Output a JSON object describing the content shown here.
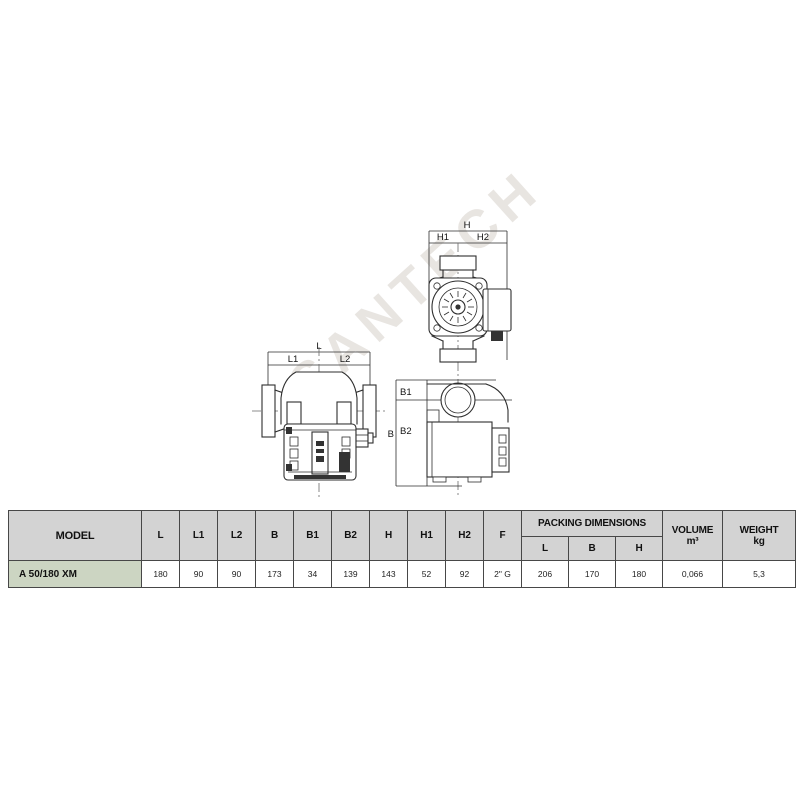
{
  "watermark": "SANTECH",
  "colors": {
    "header-bg": "#d3d3d3",
    "model-bg": "#ccd5c2",
    "border": "#474747",
    "line": "#2e2e2e",
    "watermark": "#d6d0ca"
  },
  "drawings": {
    "side_view": {
      "dim_total": "L",
      "dim_left": "L1",
      "dim_right": "L2"
    },
    "front_view": {
      "dim_total": "H",
      "dim_left": "H1",
      "dim_right": "H2"
    },
    "top_view": {
      "dim_total": "B",
      "dim_top": "B1",
      "dim_bottom": "B2"
    }
  },
  "table": {
    "headers": {
      "model": "MODEL",
      "dims": [
        "L",
        "L1",
        "L2",
        "B",
        "B1",
        "B2",
        "H",
        "H1",
        "H2",
        "F"
      ],
      "packing": "PACKING DIMENSIONS",
      "packing_sub": [
        "L",
        "B",
        "H"
      ],
      "volume_line1": "VOLUME",
      "volume_line2": "m³",
      "weight_line1": "WEIGHT",
      "weight_line2": "kg"
    },
    "rows": [
      {
        "model": "A 50/180 XM",
        "values": [
          "180",
          "90",
          "90",
          "173",
          "34",
          "139",
          "143",
          "52",
          "92",
          "2\" G",
          "206",
          "170",
          "180",
          "0,066",
          "5,3"
        ]
      }
    ]
  }
}
